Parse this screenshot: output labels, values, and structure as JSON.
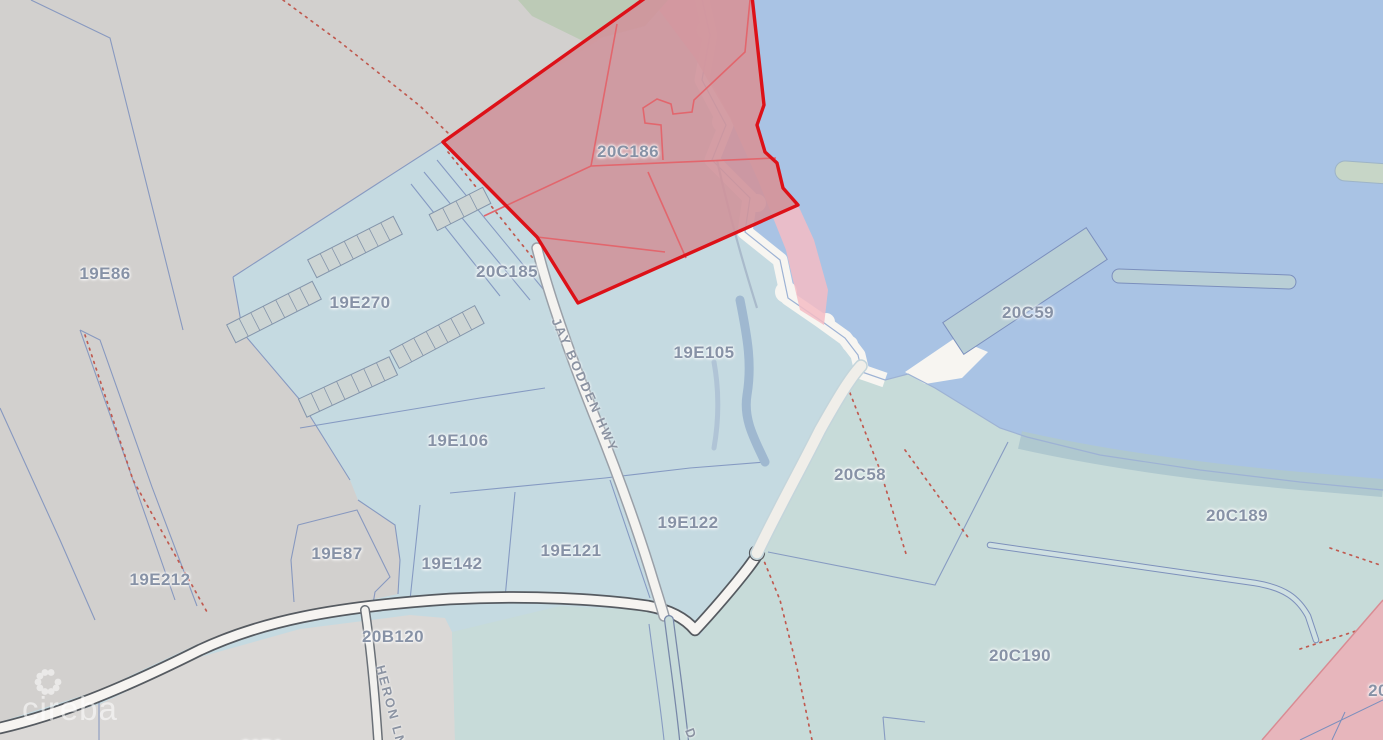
{
  "map": {
    "title": "Cadastral parcel map",
    "watermark": {
      "text": "cireba"
    },
    "selected_parcel": {
      "id": "20C186",
      "border_color": "#dd1118",
      "fill_color": "#cf949b"
    },
    "road_names": [
      "JAY BODDEN HWY",
      "HERON LN"
    ],
    "labels": [
      {
        "text": "19E86",
        "x": 105,
        "y": 274,
        "kind": "parcel"
      },
      {
        "text": "19E270",
        "x": 360,
        "y": 303,
        "kind": "parcel"
      },
      {
        "text": "20C185",
        "x": 507,
        "y": 272,
        "kind": "parcel"
      },
      {
        "text": "20C186",
        "x": 628,
        "y": 152,
        "kind": "parcel"
      },
      {
        "text": "19E105",
        "x": 704,
        "y": 353,
        "kind": "parcel"
      },
      {
        "text": "19E106",
        "x": 458,
        "y": 441,
        "kind": "parcel"
      },
      {
        "text": "19E122",
        "x": 688,
        "y": 523,
        "kind": "parcel"
      },
      {
        "text": "19E121",
        "x": 571,
        "y": 551,
        "kind": "parcel"
      },
      {
        "text": "19E142",
        "x": 452,
        "y": 564,
        "kind": "parcel"
      },
      {
        "text": "19E87",
        "x": 337,
        "y": 554,
        "kind": "parcel"
      },
      {
        "text": "19E212",
        "x": 160,
        "y": 580,
        "kind": "parcel"
      },
      {
        "text": "20B120",
        "x": 393,
        "y": 637,
        "kind": "parcel"
      },
      {
        "text": "20C59",
        "x": 1028,
        "y": 313,
        "kind": "parcel"
      },
      {
        "text": "20C58",
        "x": 860,
        "y": 475,
        "kind": "parcel"
      },
      {
        "text": "20C189",
        "x": 1237,
        "y": 516,
        "kind": "parcel"
      },
      {
        "text": "20C190",
        "x": 1020,
        "y": 656,
        "kind": "parcel"
      },
      {
        "text": "20",
        "x": 1378,
        "y": 691,
        "kind": "parcel"
      },
      {
        "text": "20B1",
        "x": 262,
        "y": 747,
        "kind": "parcel"
      },
      {
        "text": "JAY BODDEN HWY",
        "x": 585,
        "y": 385,
        "rot": 66,
        "kind": "road"
      },
      {
        "text": "HERON LN",
        "x": 391,
        "y": 706,
        "rot": 75,
        "kind": "road"
      },
      {
        "text": "D",
        "x": 691,
        "y": 734,
        "rot": 70,
        "kind": "road"
      }
    ],
    "colors": {
      "water": "#a9c3e4",
      "land_gray": "#d2d0ce",
      "parcels_cyan": "#c5dae1",
      "parcels_teal": "#c7dbd9",
      "beach": "#f7f5f1",
      "selected_fill": "#cf949b",
      "selected_border": "#dd1118",
      "boundary_blue": "#7b8fbd",
      "dotted_boundary": "#c05a50"
    }
  }
}
